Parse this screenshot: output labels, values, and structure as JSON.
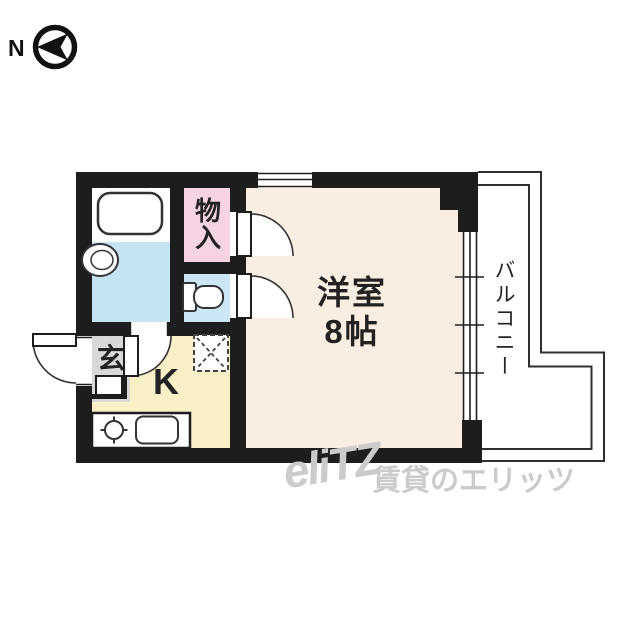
{
  "compass": {
    "label": "N"
  },
  "floor_plan": {
    "western_room": {
      "label": "洋室",
      "size": "8帖"
    },
    "closet": {
      "label": "物入"
    },
    "balcony": {
      "label": "バルコニー"
    },
    "kitchen": {
      "label": "K"
    },
    "entrance": {
      "label": "玄"
    }
  },
  "watermark": {
    "logo": "eliTZ",
    "company": "賃貸のエリッツ"
  },
  "icons": {
    "north_arrow": "left-pointing-arrowhead-in-circle",
    "bathtub": "rounded-rectangle",
    "washbasin": "nested-ovals",
    "toilet": "tank-and-bowl",
    "stove_burner": "circle-with-cross-ticks",
    "kitchen_sink": "rounded-rectangle",
    "refrigerator_space": "dashed-box-with-x",
    "door_swing": "quarter-arc-with-leaf",
    "window": "parallel-lines"
  },
  "colors": {
    "wall": "#1d1d1d",
    "western_room": "#faeee2",
    "kitchen": "#f9f0c8",
    "closet": "#f6d4e3",
    "toilet_room": "#cbe6f5",
    "bathroom": "#c5e3f1",
    "entrance_hall": "#d8d8d8",
    "outline": "#2f2f2f",
    "watermark": "#cbcbcb",
    "text": "#222222"
  }
}
